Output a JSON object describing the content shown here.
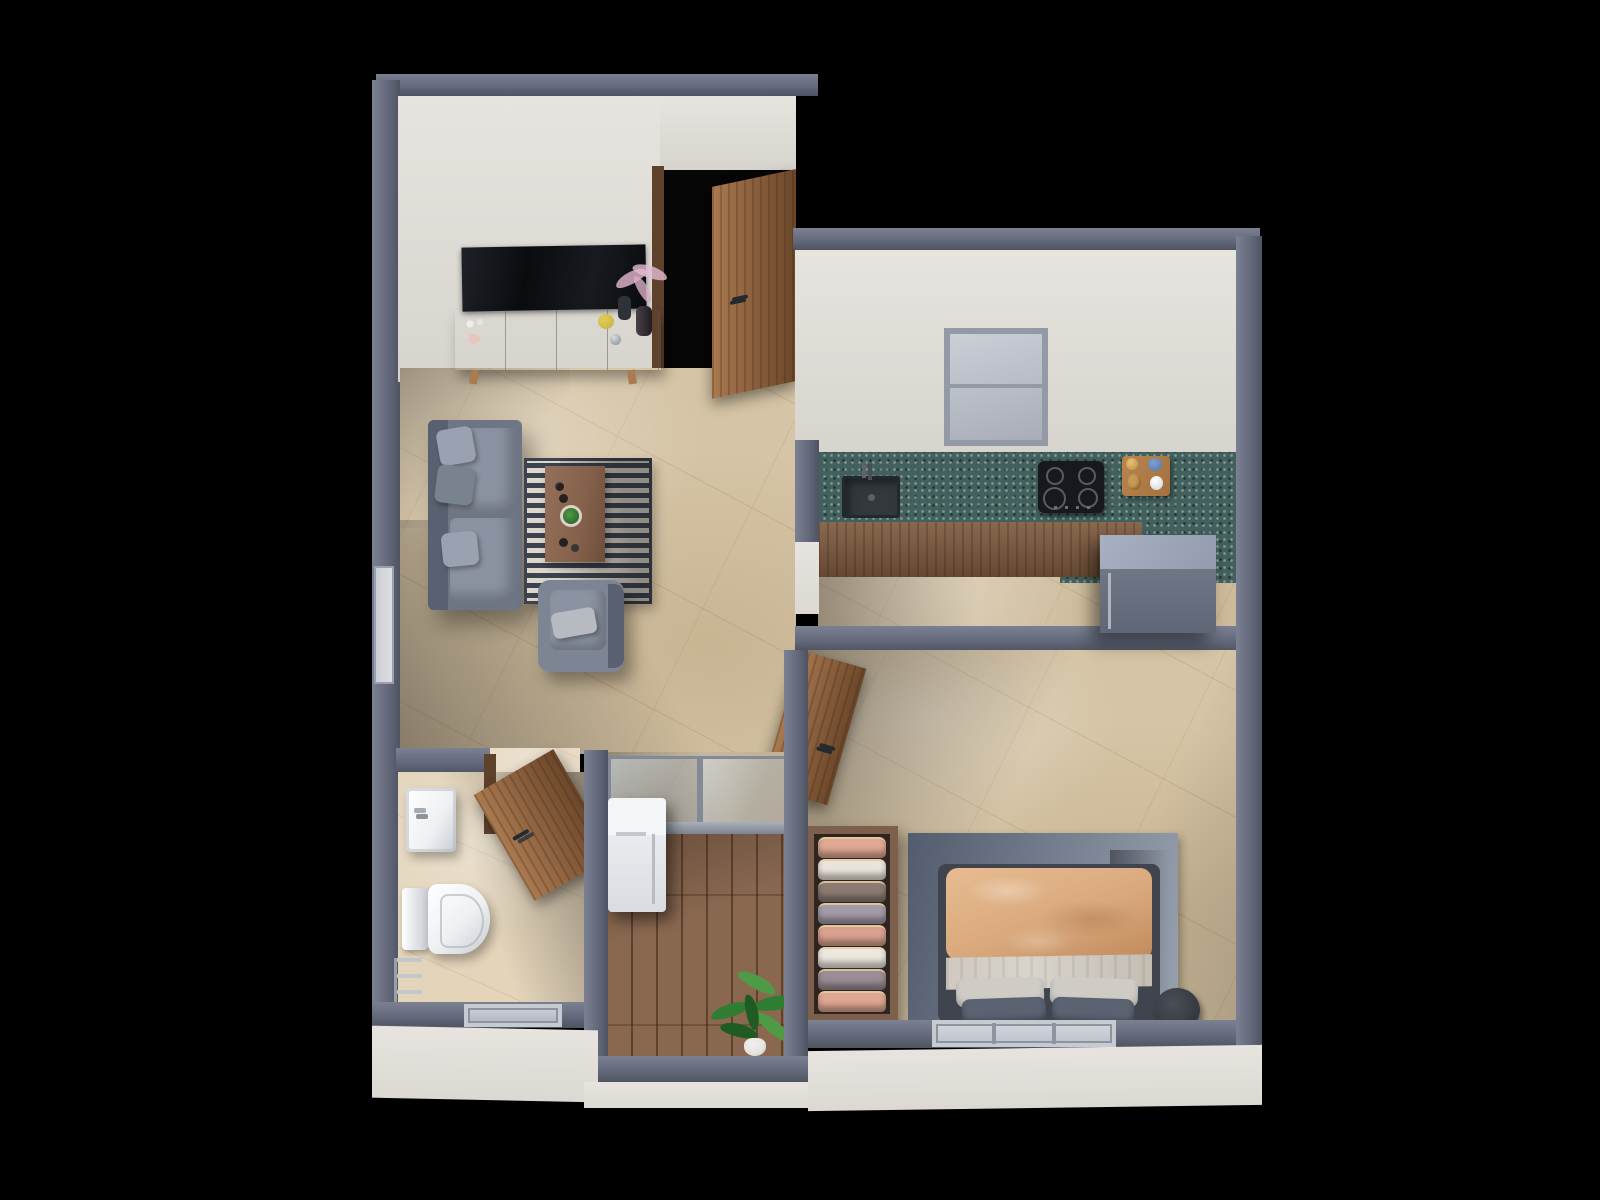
{
  "scene": {
    "kind": "3d-floor-plan-render",
    "view": "top-down-axonometric",
    "rooms": [
      {
        "name": "living-room",
        "furniture": [
          "wall-tv",
          "tv-console",
          "decor-vases",
          "pink-feather-plant",
          "sofa",
          "throw-pillows",
          "striped-rug",
          "coffee-table",
          "armchair",
          "entrance-door"
        ]
      },
      {
        "name": "kitchen",
        "furniture": [
          "window",
          "teal-countertop",
          "sink",
          "faucet",
          "gas-cooktop",
          "serving-tray",
          "base-cabinets",
          "refrigerator"
        ]
      },
      {
        "name": "bedroom",
        "furniture": [
          "wood-door",
          "open-wardrobe",
          "hanging-clothes",
          "area-rug",
          "double-bed",
          "duvet",
          "sheet",
          "pillows",
          "side-table",
          "window"
        ]
      },
      {
        "name": "bathroom",
        "furniture": [
          "wood-door",
          "washbasin",
          "toilet",
          "towel-rail",
          "window"
        ]
      },
      {
        "name": "balcony",
        "furniture": [
          "glass-partition",
          "washing-machine",
          "wood-deck",
          "potted-plant"
        ]
      }
    ]
  },
  "palette": {
    "bg": "#000000",
    "void": "#060607",
    "wallTop": "#646a7c",
    "wallTopDark": "#4e5361",
    "wallTopLight": "#7b8192",
    "wallFace": "#e7e4df",
    "wallFaceDim": "#d7d3cd",
    "marble": "#d5c4a5",
    "marbleBath": "#e3d4ba",
    "woodDoor": "#8d6240",
    "woodLight": "#aa7a50",
    "woodDark": "#6b4629",
    "woodFrame": "#5f422c",
    "woodCabinet": "#7b583c",
    "woodDeck": "#8a6850",
    "woodTable": "#85614b",
    "counter": "#42605d",
    "sinkDark": "#33383d",
    "cooktop": "#17191c",
    "burnerRing": "#585d64",
    "trayWood": "#a4713f",
    "sofa": "#6e7686",
    "sofaLight": "#8b93a2",
    "sofaDark": "#596070",
    "pillowGray": "#9aa2b1",
    "rugCream": "#ddd8cb",
    "rugDark": "#3b4250",
    "armchair": "#7d8595",
    "duvet": "#d9a97d",
    "duvetShade": "#c08a5c",
    "sheet": "#d9d4cb",
    "pillowBeige": "#cfccc6",
    "pillowNavy": "#5b6373",
    "bedRugA": "#525c6e",
    "bedRugB": "#97a0ad",
    "bedFrame": "#3f444e",
    "wardrobeWood": "#7d5f4c",
    "wardrobeInside": "#2e2520",
    "fridgeTop": "#939cae",
    "fridgeFront": "#6f7787",
    "glassFrame": "#828a96",
    "windowGlass": "#b7bcc5",
    "windowFrame": "#939aa5",
    "fixtureWhite": "#eef0f2",
    "fixtureShadow": "#c7cbd1",
    "washer": "#e9ebee",
    "chrome": "#c2c7cd",
    "tvBlack": "#0a0c0f",
    "consoleGray": "#c9c7c7",
    "consoleTop": "#d6d4d4",
    "plantGreen": "#2f7c33",
    "plantGreenDark": "#1f5c24",
    "plantGreenLight": "#4f9a44",
    "plantPink": "#d8aec4",
    "potWhite": "#e6e4e0",
    "teapotYellow": "#c8b13c",
    "vaseDark": "#2e3238",
    "bowlBlue": "#5377a8",
    "breadTan": "#c59a55"
  },
  "wardrobe": {
    "garment_colors": [
      "#dfa893",
      "#e9e3da",
      "#8b7b73",
      "#a39aa8",
      "#d9a28f",
      "#ece7df",
      "#9b8d95",
      "#dfa893",
      "#cabcb2"
    ]
  }
}
